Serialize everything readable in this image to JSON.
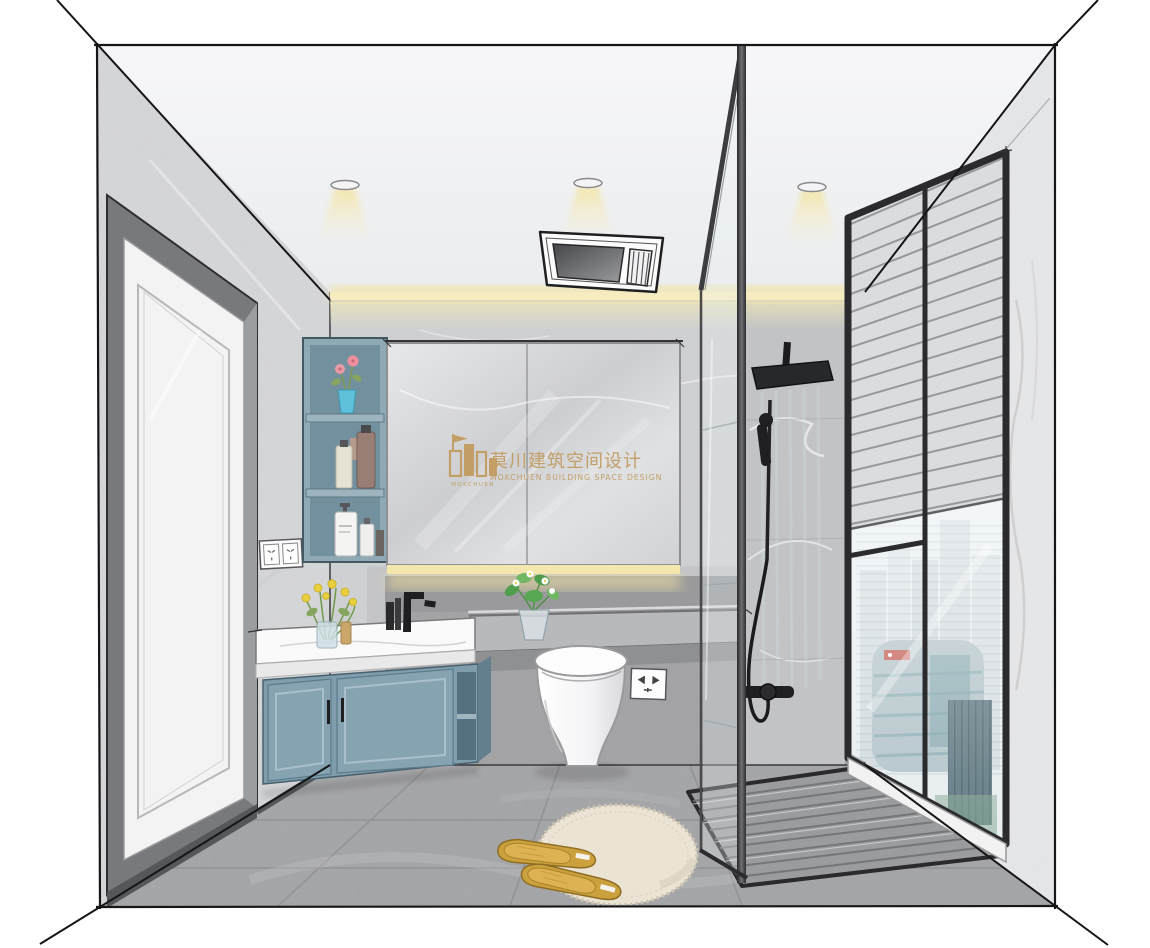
{
  "watermark": {
    "brand_cn": "莫川建筑空间设计",
    "brand_en": "MOKCHUEN BUILDING SPACE DESIGN",
    "logo_caption": "MOKCHUEN",
    "color": "#c29a5e"
  },
  "scene": {
    "kind": "bathroom-interior-sketch-rendering",
    "objects": [
      "perspective-guide-lines",
      "ceiling-downlights",
      "ceiling-heater-unit",
      "cove-led-strip",
      "entry-door",
      "wall-outlet",
      "open-shelf-unit",
      "mirror-cabinet",
      "vanity-countertop",
      "vanity-cabinet",
      "faucet",
      "flower-vase",
      "stone-bench",
      "toilet",
      "toilet-outlet",
      "ledge-plant",
      "glass-partition",
      "rain-shower-head",
      "hand-shower",
      "shower-valve",
      "shower-floor",
      "window",
      "venetian-blinds",
      "city-view",
      "bath-mat",
      "slippers"
    ],
    "palette": {
      "wall_light": "#d6d7d9",
      "wall_dark": "#a7a7a9",
      "floor_gray": "#a3a4a6",
      "cabinet_blue": "#7f9dad",
      "counter_white": "#fafafa",
      "frame_black": "#2e2e2e",
      "led_yellow": "#f3e7ae",
      "slipper_yellow": "#d2a243",
      "rug_cream": "#ebe4d5",
      "glass_tint": "#e8f1f3",
      "watermark_gold": "#c29a5e"
    }
  }
}
